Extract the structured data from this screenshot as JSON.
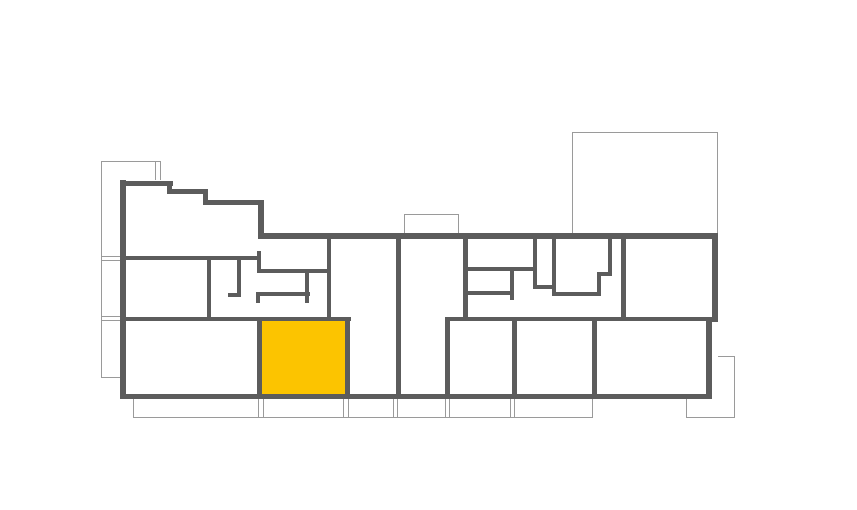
{
  "canvas": {
    "width": 857,
    "height": 510,
    "background": "#FFFFFF"
  },
  "colors": {
    "wall": "#5C5C5C",
    "thin_line": "#9A9A9A",
    "room_fill": "#FFFFFF",
    "highlight": "#FCC400"
  },
  "floor_plan": {
    "selected_unit": {
      "x": 262,
      "y": 321,
      "w": 84,
      "h": 73,
      "color": "#FCC400"
    },
    "footprint_fills": [
      [
        120,
        180,
        146,
        219
      ],
      [
        264,
        236,
        454,
        163
      ]
    ],
    "balcony_lines": [
      [
        101,
        161,
        1,
        217
      ],
      [
        101,
        161,
        59,
        1
      ],
      [
        155,
        161,
        1,
        21
      ],
      [
        160,
        161,
        1,
        21
      ],
      [
        101,
        256,
        19,
        1
      ],
      [
        101,
        260,
        19,
        1
      ],
      [
        101,
        316,
        19,
        1
      ],
      [
        101,
        320,
        19,
        1
      ],
      [
        101,
        377,
        19,
        1
      ],
      [
        404,
        214,
        1,
        22
      ],
      [
        458,
        214,
        1,
        22
      ],
      [
        404,
        214,
        55,
        1
      ],
      [
        572,
        132,
        1,
        104
      ],
      [
        717,
        132,
        1,
        104
      ],
      [
        572,
        132,
        146,
        1
      ],
      [
        133,
        417,
        459,
        1
      ],
      [
        133,
        398,
        1,
        20
      ],
      [
        258,
        398,
        1,
        20
      ],
      [
        263,
        398,
        1,
        20
      ],
      [
        343,
        398,
        1,
        20
      ],
      [
        348,
        398,
        1,
        20
      ],
      [
        393,
        398,
        1,
        20
      ],
      [
        397,
        398,
        1,
        20
      ],
      [
        445,
        398,
        1,
        20
      ],
      [
        449,
        398,
        1,
        20
      ],
      [
        510,
        398,
        1,
        20
      ],
      [
        514,
        398,
        1,
        20
      ],
      [
        592,
        398,
        1,
        20
      ],
      [
        686,
        356,
        48,
        1
      ],
      [
        686,
        417,
        48,
        1
      ],
      [
        686,
        356,
        1,
        62
      ],
      [
        734,
        356,
        1,
        62
      ]
    ],
    "walls_exterior": [
      [
        120,
        180,
        6,
        219
      ],
      [
        120,
        181,
        53,
        5
      ],
      [
        167,
        181,
        5,
        13
      ],
      [
        167,
        189,
        41,
        5
      ],
      [
        203,
        189,
        5,
        15
      ],
      [
        203,
        200,
        61,
        5
      ],
      [
        258,
        200,
        6,
        39
      ],
      [
        258,
        233,
        460,
        6
      ],
      [
        712,
        233,
        6,
        87
      ],
      [
        706,
        318,
        12,
        4
      ],
      [
        706,
        318,
        6,
        81
      ],
      [
        120,
        394,
        592,
        5
      ]
    ],
    "walls_interior": [
      [
        123,
        256,
        137,
        4
      ],
      [
        207,
        258,
        4,
        62
      ],
      [
        123,
        317,
        228,
        4
      ],
      [
        257,
        251,
        4,
        22
      ],
      [
        258,
        269,
        73,
        4
      ],
      [
        327,
        236,
        4,
        85
      ],
      [
        237,
        258,
        4,
        39
      ],
      [
        228,
        293,
        13,
        4
      ],
      [
        256,
        292,
        54,
        4
      ],
      [
        305,
        271,
        4,
        32
      ],
      [
        256,
        292,
        4,
        11
      ],
      [
        396,
        236,
        5,
        163
      ],
      [
        257,
        317,
        5,
        82
      ],
      [
        345,
        317,
        5,
        82
      ],
      [
        463,
        236,
        5,
        85
      ],
      [
        463,
        267,
        73,
        4
      ],
      [
        510,
        267,
        4,
        33
      ],
      [
        463,
        291,
        47,
        4
      ],
      [
        533,
        236,
        4,
        52
      ],
      [
        533,
        285,
        23,
        4
      ],
      [
        552,
        236,
        4,
        58
      ],
      [
        552,
        292,
        49,
        4
      ],
      [
        597,
        272,
        4,
        24
      ],
      [
        597,
        272,
        15,
        4
      ],
      [
        608,
        236,
        4,
        40
      ],
      [
        621,
        236,
        5,
        85
      ],
      [
        445,
        317,
        267,
        4
      ],
      [
        445,
        317,
        5,
        82
      ],
      [
        512,
        317,
        5,
        82
      ],
      [
        592,
        317,
        5,
        82
      ]
    ]
  }
}
